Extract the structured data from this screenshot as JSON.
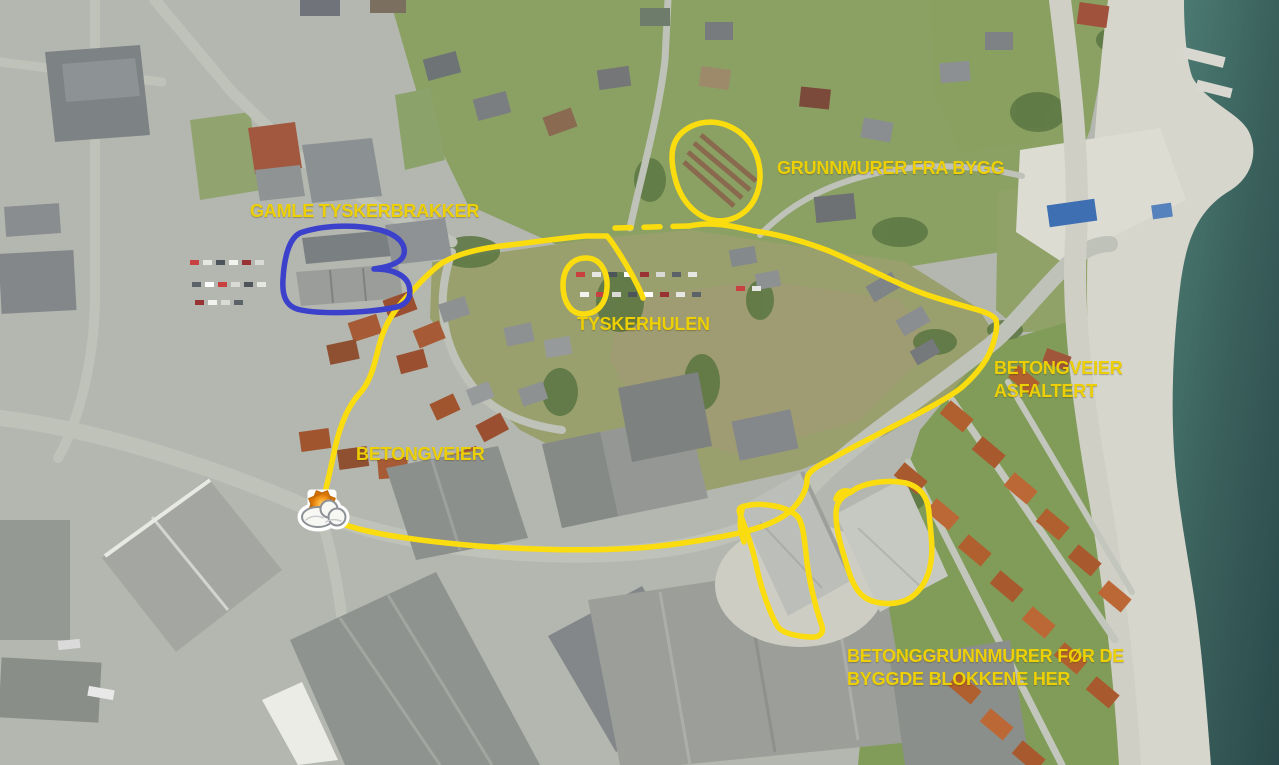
{
  "map": {
    "kind": "annotated aerial photograph",
    "labels": {
      "grunnmurer_fra_bygg": "GRUNNMURER FRA BYGG",
      "gamle_tyskerbrakker": "GAMLE TYSKERBRAKKER",
      "tyskerhulen": "TYSKERHULEN",
      "betongveier_asfaltert_1": "BETONGVEIER",
      "betongveier_asfaltert_2": "ASFALTERT",
      "betongveier": "BETONGVEIER",
      "betonggrunnmurer_1": "BETONGGRUNNMURER FØR DE",
      "betonggrunnmurer_2": "BYGGDE BLOKKENE HER"
    },
    "annotation_colors": {
      "highlight_yellow": "#fbdc0e",
      "outline_blue": "#3c41cc"
    },
    "icons": [
      {
        "name": "partly-cloudy-weather-icon"
      }
    ]
  }
}
